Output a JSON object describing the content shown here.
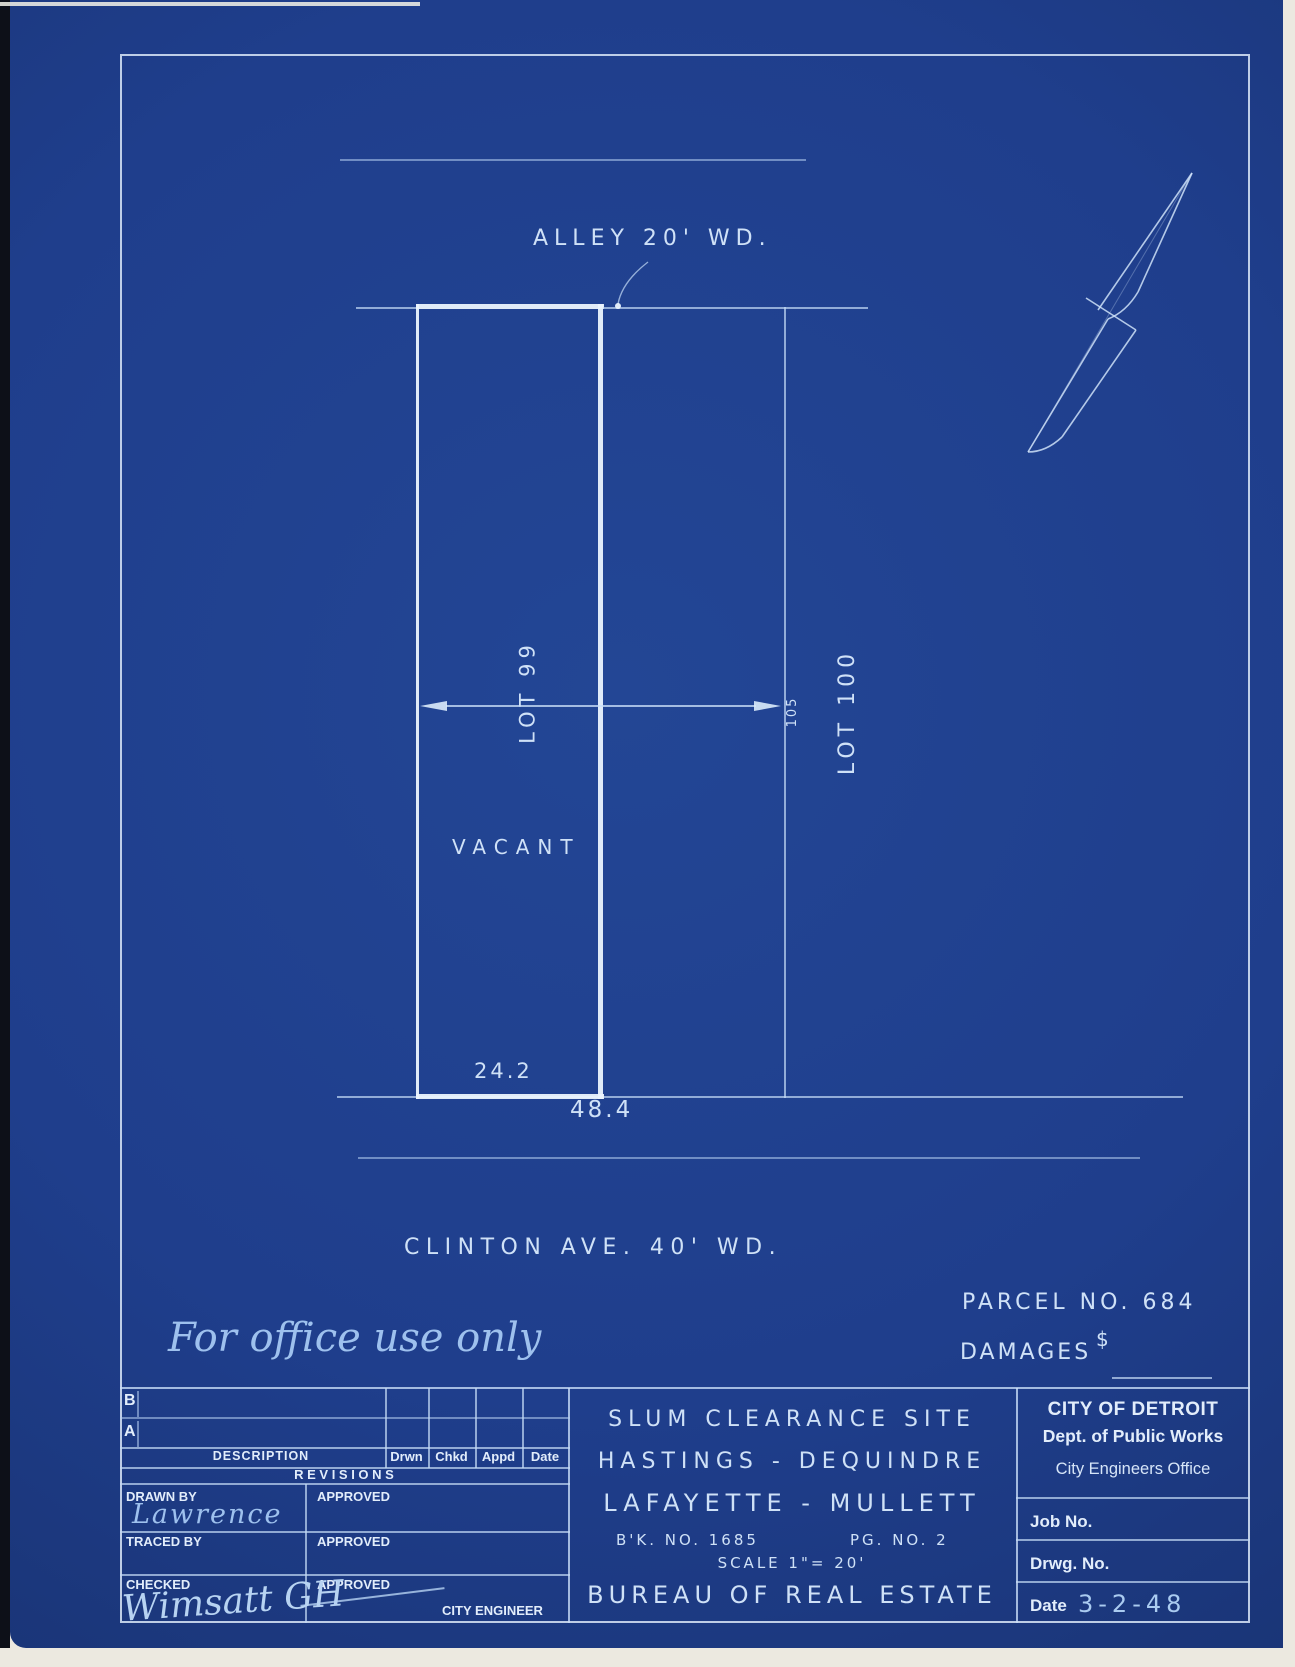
{
  "drawing": {
    "alley_label": "ALLEY 20' WD.",
    "lot99_label": "LOT 99",
    "depth_dim": "105",
    "lot100_label": "LOT 100",
    "vacant_label": "VACANT",
    "width_dim_inner": "24.2",
    "width_dim_outer": "48.4",
    "street_label": "CLINTON AVE. 40' WD."
  },
  "annotations": {
    "parcel_no": "PARCEL NO. 684",
    "damages_label": "DAMAGES",
    "damages_currency": "$",
    "office_note": "For office use only"
  },
  "icons": {
    "north_arrow": "compass-needle pointing north-east"
  },
  "title_block": {
    "revisions": {
      "row_b": "B",
      "row_a": "A",
      "description_header": "DESCRIPTION",
      "col_drwn": "Drwn",
      "col_chkd": "Chkd",
      "col_appd": "Appd",
      "col_date": "Date",
      "table_title": "R E V I S I O N S"
    },
    "signoff": {
      "drawn_by_label": "DRAWN BY",
      "drawn_by_value": "Lawrence",
      "traced_by_label": "TRACED BY",
      "checked_label": "CHECKED",
      "checked_signature": "Wimsatt GH",
      "approved_label": "APPROVED",
      "city_engineer_label": "CITY ENGINEER"
    },
    "project": {
      "line1": "SLUM CLEARANCE SITE",
      "line2": "HASTINGS - DEQUINDRE",
      "line3": "LAFAYETTE - MULLETT",
      "book_no": "B'K. NO. 1685",
      "page_no": "PG. NO. 2",
      "scale": "SCALE 1\"= 20'",
      "bureau": "BUREAU OF REAL ESTATE"
    },
    "agency": {
      "city": "CITY OF DETROIT",
      "dept": "Dept. of Public Works",
      "office": "City Engineers Office",
      "job_no_label": "Job No.",
      "drwg_no_label": "Drwg. No.",
      "date_label": "Date",
      "date_value": "3-2-48"
    }
  }
}
